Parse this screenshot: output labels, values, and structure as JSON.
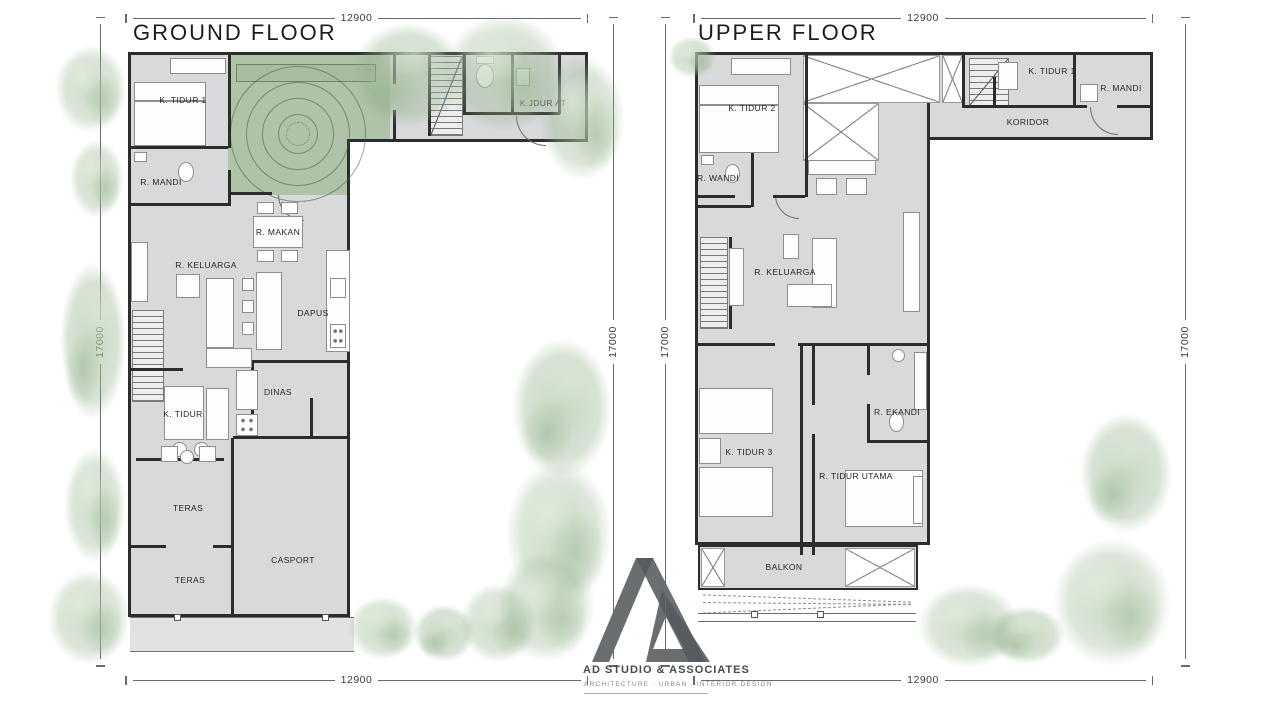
{
  "ground_floor": {
    "title": "GROUND FLOOR",
    "dims": {
      "top": "12900",
      "bottom": "12900",
      "left": "17000",
      "right": "17000"
    },
    "rooms": [
      {
        "label": "K. TIDUR 1",
        "x": 55,
        "y": 48
      },
      {
        "label": "R. MANDI",
        "x": 33,
        "y": 130
      },
      {
        "label": "K.JDUR AT",
        "x": 415,
        "y": 51
      },
      {
        "label": "R. MAKAN",
        "x": 150,
        "y": 180
      },
      {
        "label": "R. KELUARGA",
        "x": 78,
        "y": 213
      },
      {
        "label": "DAPUS",
        "x": 185,
        "y": 261
      },
      {
        "label": "DINAS",
        "x": 150,
        "y": 340
      },
      {
        "label": "K. TIDUR",
        "x": 55,
        "y": 362
      },
      {
        "label": "TERAS",
        "x": 60,
        "y": 456
      },
      {
        "label": "CASPORT",
        "x": 165,
        "y": 508
      },
      {
        "label": "TERAS",
        "x": 62,
        "y": 528
      }
    ]
  },
  "upper_floor": {
    "title": "UPPER FLOOR",
    "dims": {
      "top": "12900",
      "bottom": "12900",
      "left": "17000",
      "right": "17000"
    },
    "rooms": [
      {
        "label": "K. TIDUR 2",
        "x": 57,
        "y": 56
      },
      {
        "label": "K. TIDUR 1",
        "x": 357,
        "y": 19
      },
      {
        "label": "R. MANDI",
        "x": 426,
        "y": 36
      },
      {
        "label": "KORIDOR",
        "x": 333,
        "y": 70
      },
      {
        "label": "R. WANDI",
        "x": 23,
        "y": 126
      },
      {
        "label": "R. KELUARGA",
        "x": 90,
        "y": 220
      },
      {
        "label": "K. TIDUR 3",
        "x": 54,
        "y": 400
      },
      {
        "label": "R. EKANDI",
        "x": 202,
        "y": 360
      },
      {
        "label": "R. TIDUR UTAMA",
        "x": 161,
        "y": 424
      },
      {
        "label": "BALKON",
        "x": 89,
        "y": 515
      }
    ]
  },
  "logo": {
    "name": "AD STUDIO & ASSOCIATES",
    "tagline": "ARCHITECTURE · URBAN · INTERIOR DESIGN"
  },
  "colors": {
    "wall": "#2c2c2d",
    "floor": "#d7d9da",
    "courtyard_green": "#aec3a7",
    "tree_green": "#b4c9ae",
    "dimension_line": "#6a6a6a",
    "logo_gray": "#55595c"
  }
}
